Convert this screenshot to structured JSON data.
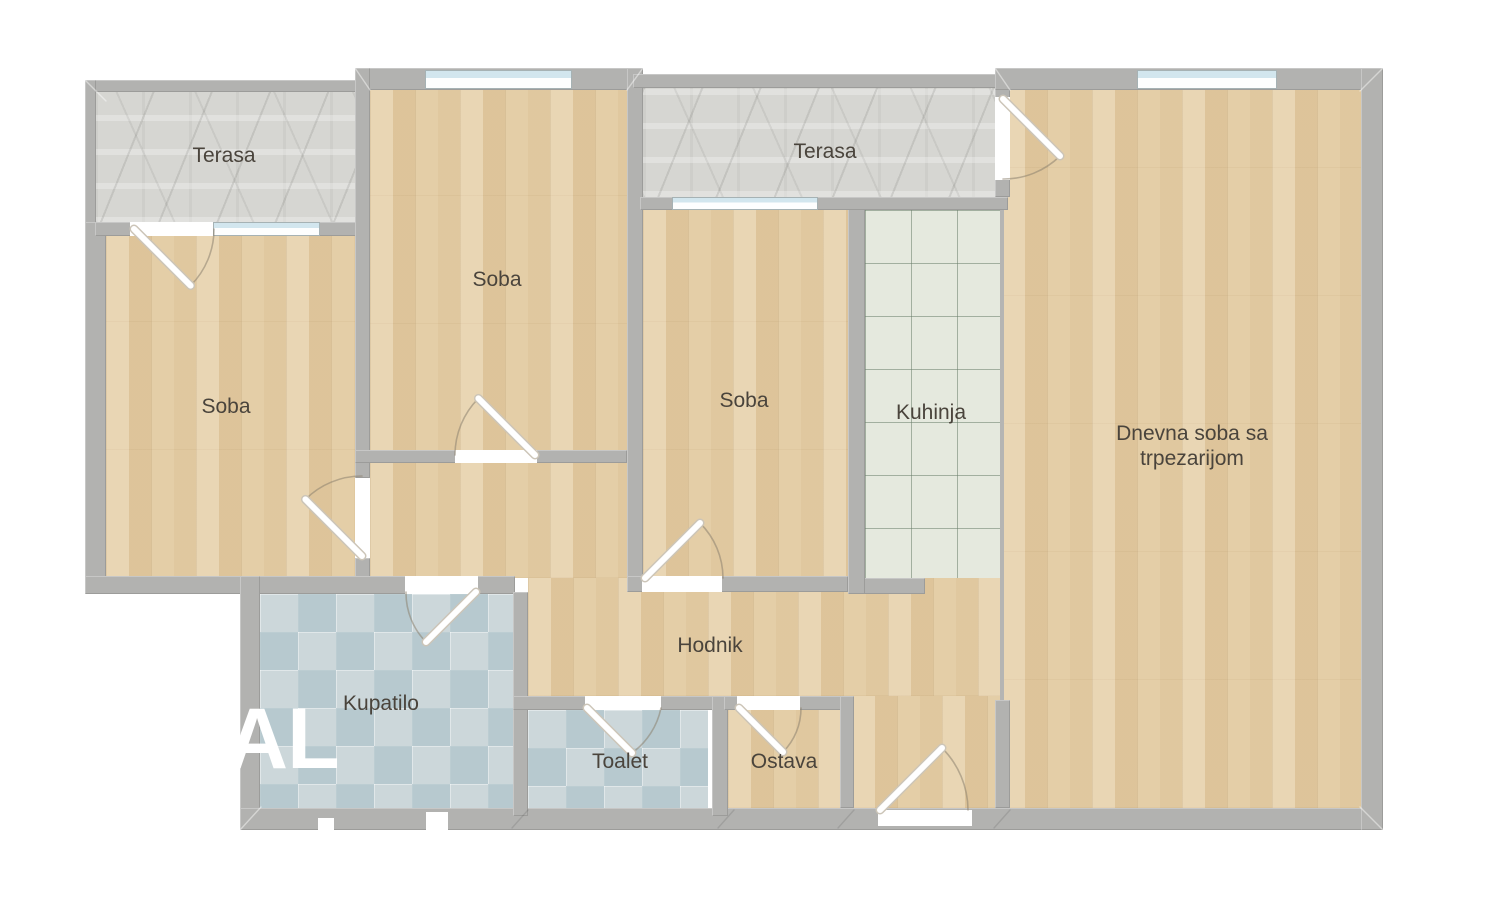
{
  "plan": {
    "labels": {
      "terasa_left": "Terasa",
      "terasa_right": "Terasa",
      "soba_top": "Soba",
      "soba_left": "Soba",
      "soba_middle": "Soba",
      "kuhinja": "Kuhinja",
      "dnevna_line1": "Dnevna soba sa",
      "dnevna_line2": "trpezarijom",
      "hodnik": "Hodnik",
      "kupatilo": "Kupatilo",
      "toalet": "Toalet",
      "ostava": "Ostava"
    },
    "watermark": "AL",
    "colors": {
      "wall": "#b2b2b0",
      "wood_floor": "#e2cba3",
      "stone_terrace": "#d6d6d2",
      "kitchen_tile": "#e5e9de",
      "bath_tile": "#ccd7da",
      "window_glass": "#d2e6ee",
      "label_text": "#4a443c",
      "watermark": "#ffffff"
    }
  }
}
